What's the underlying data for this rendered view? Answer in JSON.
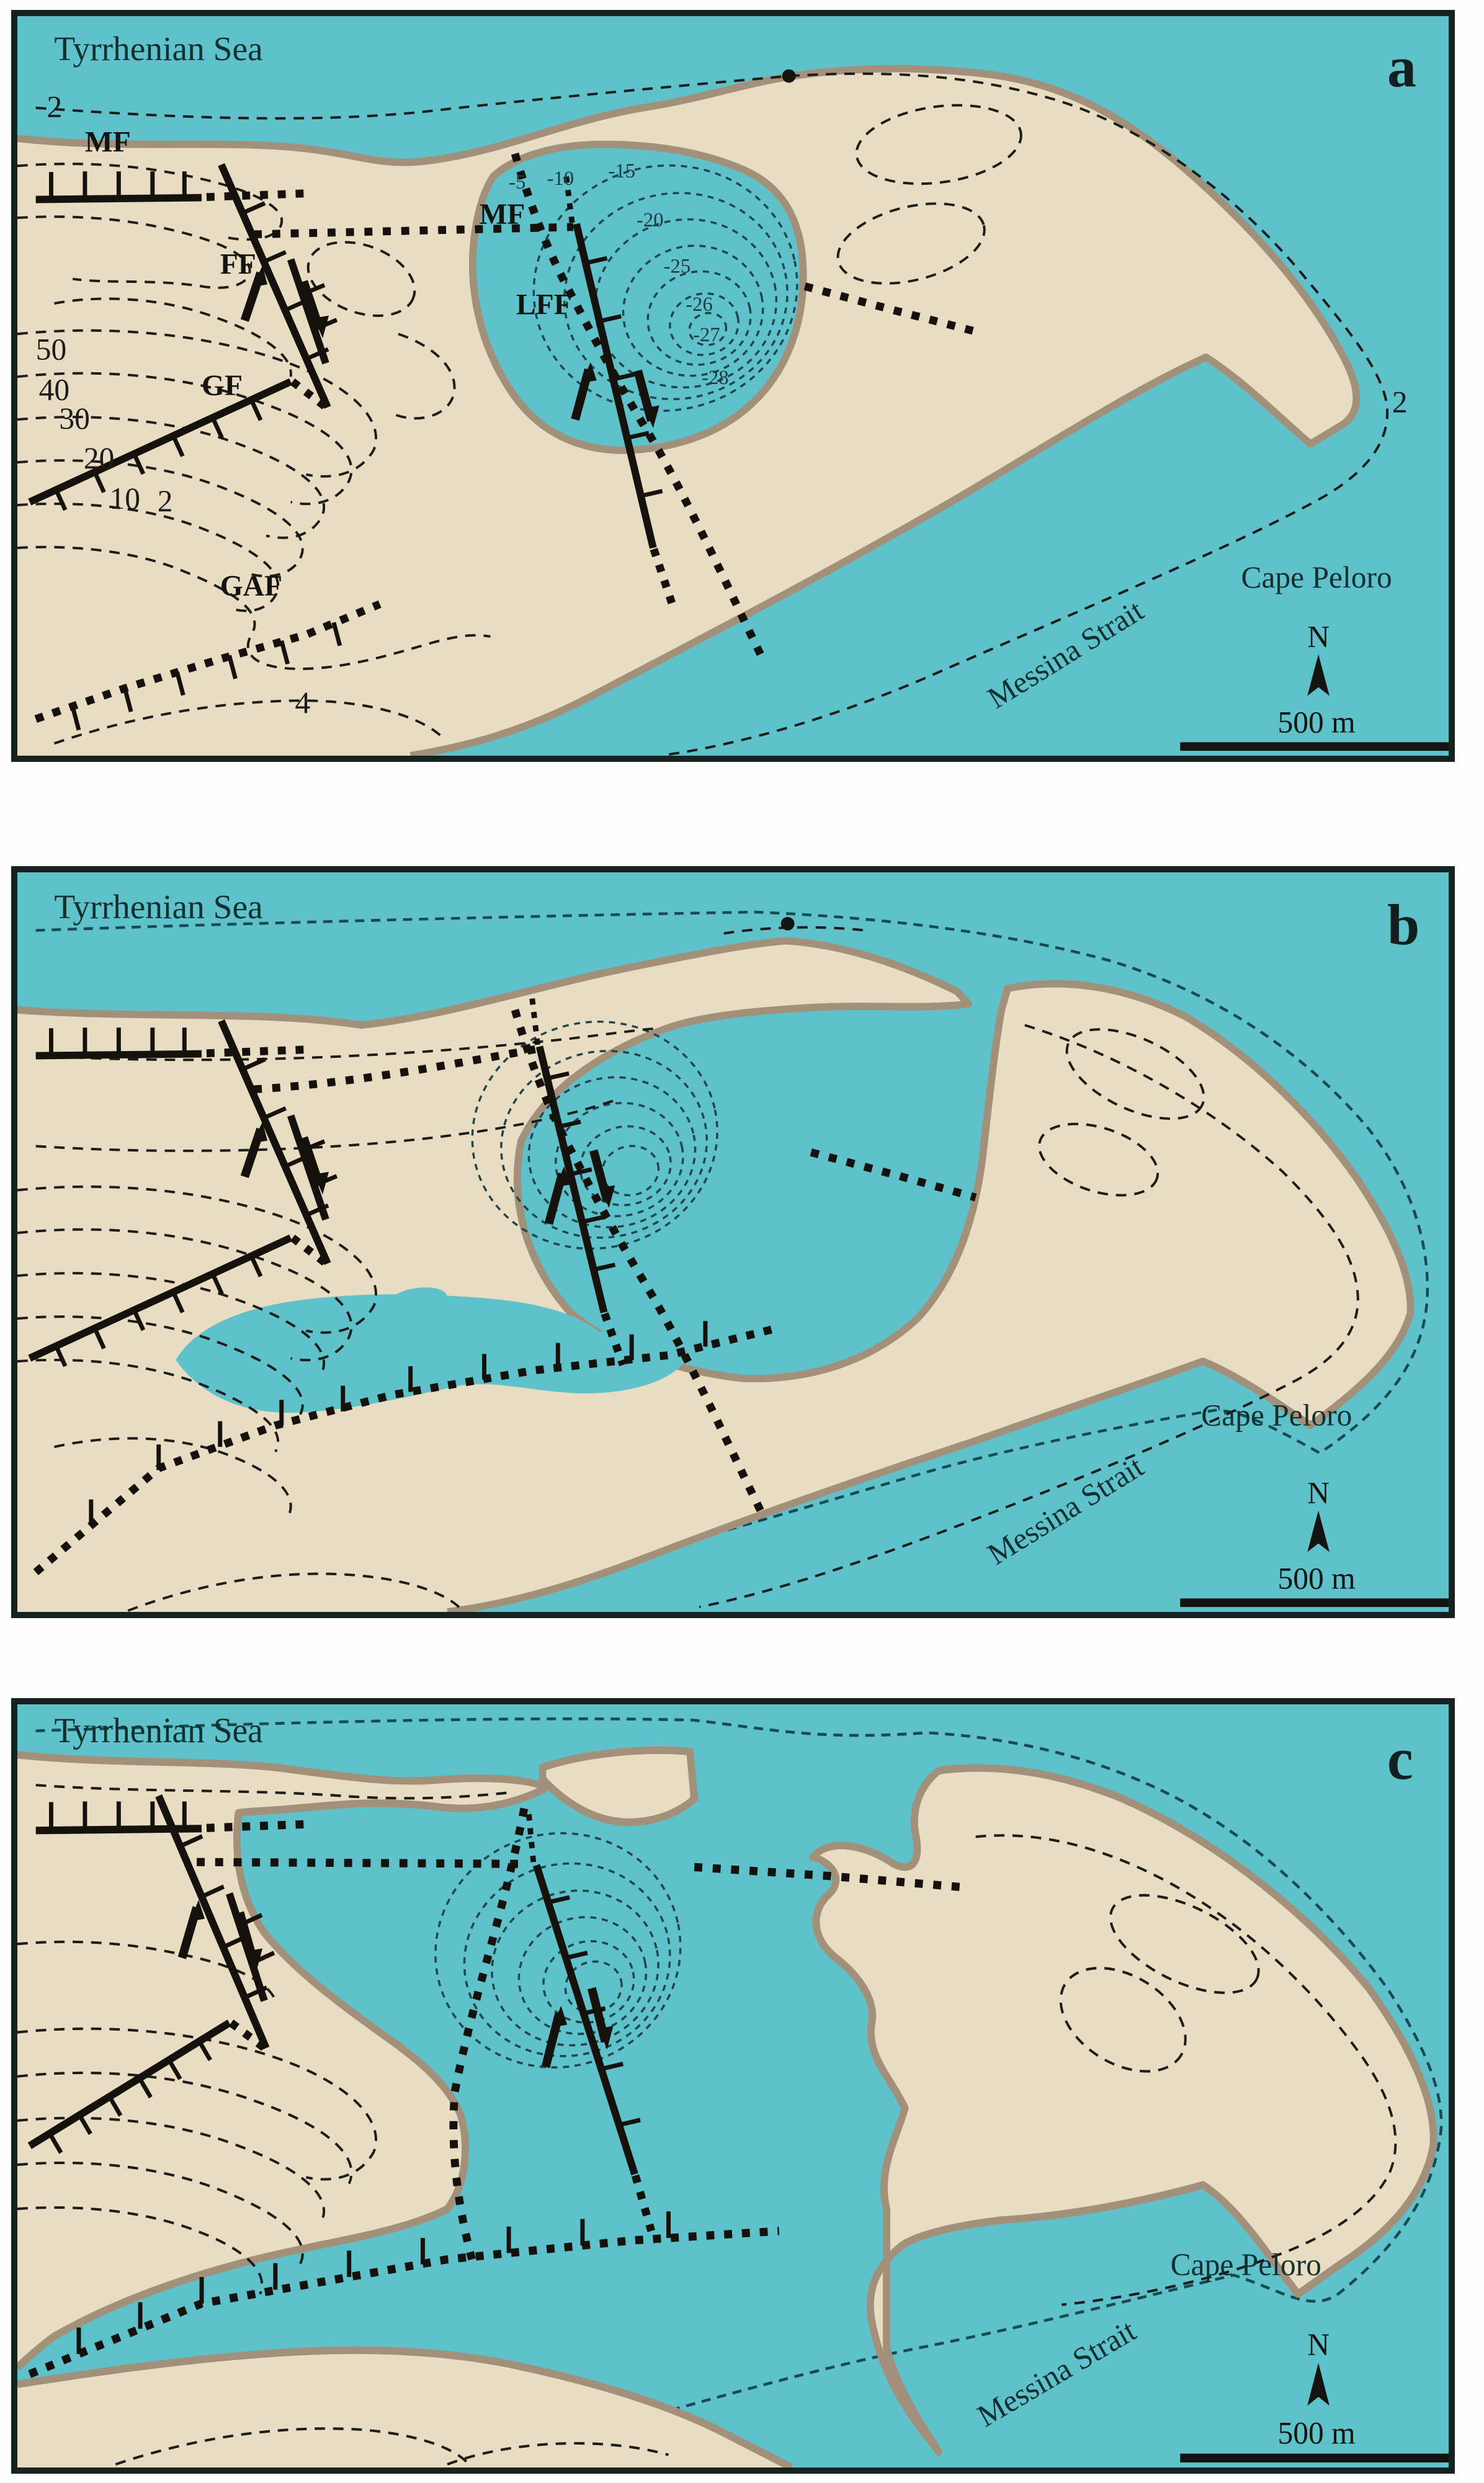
{
  "figure": {
    "panel_count": 3,
    "map_features": {
      "sea_fill": "#5fc1ca",
      "land_fill": "#e8dcc2",
      "coastline_stroke": "#a2907b",
      "fault_color": "#15120e",
      "contour_color": "#1c1c1a",
      "reference_shoreline_color": "#174b52",
      "bathymetric_contour_color": "#20454c",
      "frame_color": "#16221f"
    }
  },
  "panels": [
    {
      "letter": "a",
      "labels": {
        "sea": "Tyrrhenian Sea",
        "cape": "Cape Peloro",
        "strait": "Messina Strait",
        "north": "N",
        "scale": "500 m"
      },
      "fault_labels": {
        "mf_west": "MF",
        "mf_east": "MF",
        "ff": "FF",
        "lff": "LFF",
        "gf": "GF",
        "gaf": "GAF"
      },
      "contour_labels": {
        "top2": "2",
        "c50": "50",
        "c40": "40",
        "c30": "30",
        "c20": "20",
        "c10": "10",
        "low2": "2",
        "gaf4": "4",
        "right2": "2"
      },
      "bathymetry_labels": [
        "-5",
        "-10",
        "-15",
        "-20",
        "-25",
        "-26",
        "-27",
        "-28"
      ]
    },
    {
      "letter": "b",
      "labels": {
        "sea": "Tyrrhenian Sea",
        "cape": "Cape Peloro",
        "strait": "Messina Strait",
        "north": "N",
        "scale": "500 m"
      }
    },
    {
      "letter": "c",
      "labels": {
        "sea": "Tyrrhenian Sea",
        "cape": "Cape Peloro",
        "strait": "Messina Strait",
        "north": "N",
        "scale": "500 m"
      }
    }
  ]
}
